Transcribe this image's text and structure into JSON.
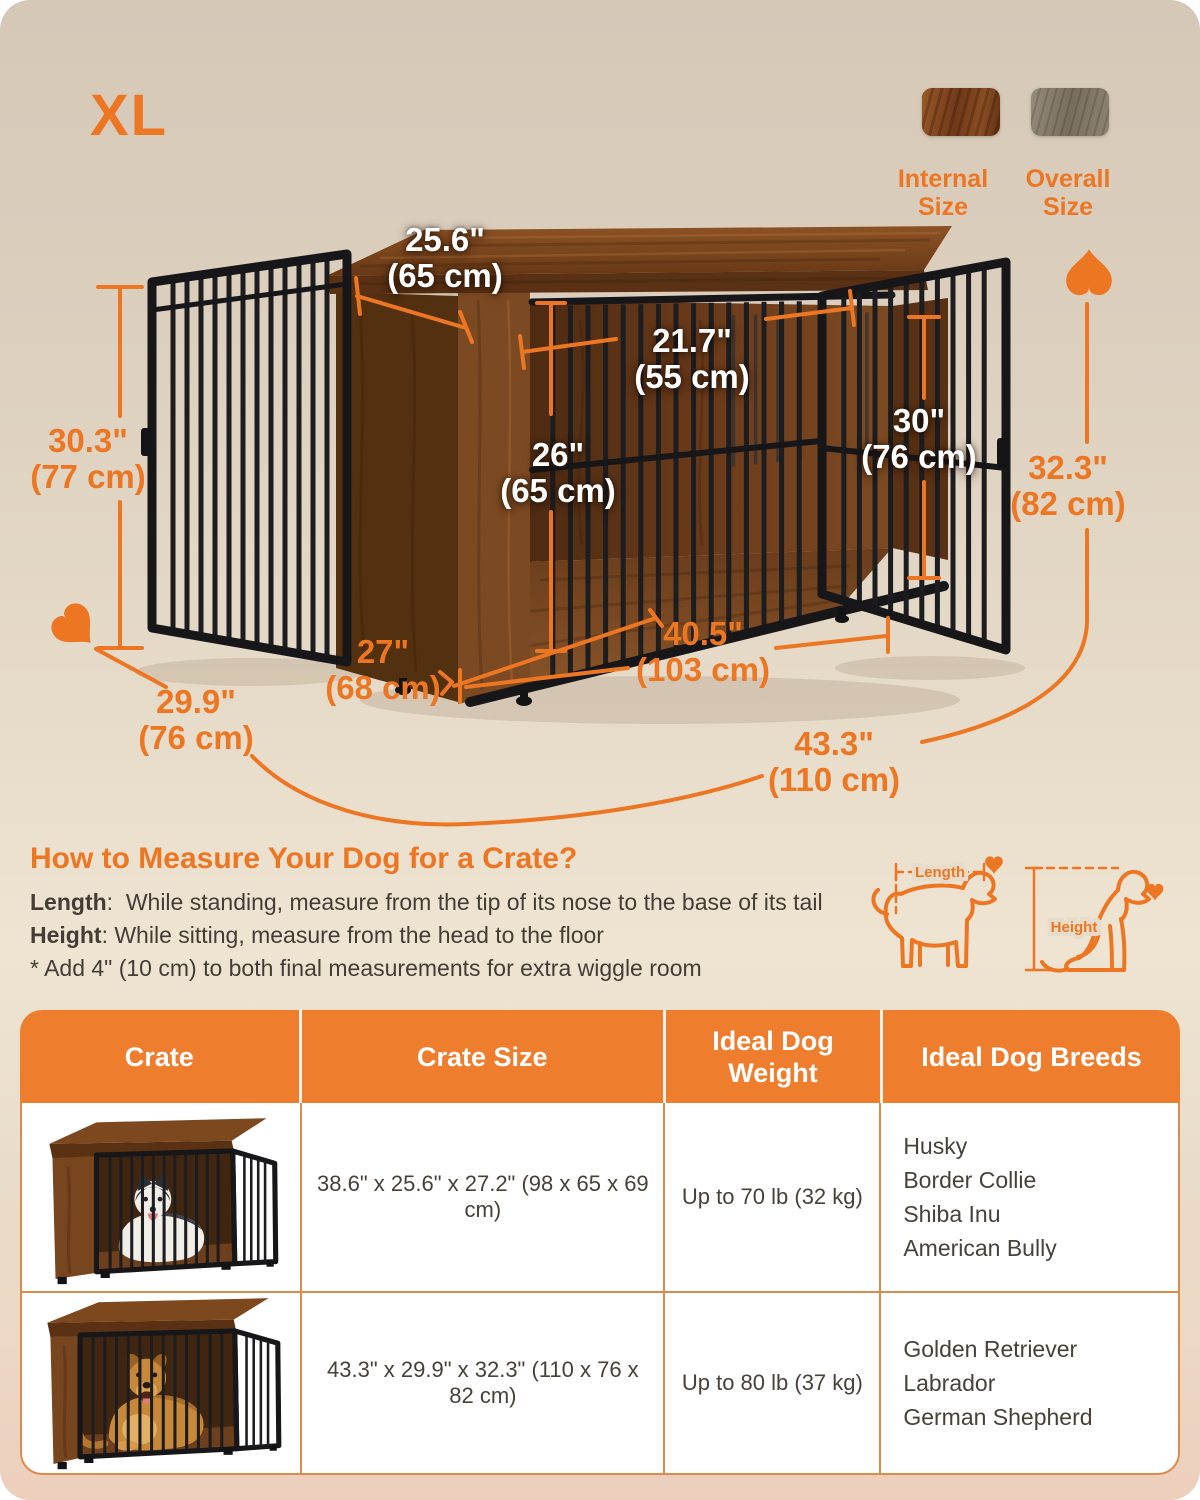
{
  "size_label": "XL",
  "legend": {
    "internal_label": "Internal Size",
    "overall_label": "Overall Size"
  },
  "dims": {
    "top_depth": {
      "in": "25.6\"",
      "cm": "(65 cm)"
    },
    "inner_depth": {
      "in": "21.7\"",
      "cm": "(55 cm)"
    },
    "inner_height": {
      "in": "26\"",
      "cm": "(65 cm)"
    },
    "door_height": {
      "in": "30\"",
      "cm": "(76 cm)"
    },
    "side_height": {
      "in": "30.3\"",
      "cm": "(77 cm)"
    },
    "overall_height": {
      "in": "32.3\"",
      "cm": "(82 cm)"
    },
    "base_depth": {
      "in": "27\"",
      "cm": "(68 cm)"
    },
    "inner_width": {
      "in": "40.5\"",
      "cm": "(103 cm)"
    },
    "overall_depth": {
      "in": "29.9\"",
      "cm": "(76 cm)"
    },
    "overall_width": {
      "in": "43.3\"",
      "cm": "(110 cm)"
    }
  },
  "measure_guide": {
    "title": "How to Measure Your Dog for a Crate?",
    "length_label": "Length",
    "length_text": ":  While standing, measure from the tip of its nose to the base of its tail",
    "height_label": "Height",
    "height_text": ": While sitting, measure from the head to the floor",
    "note": "* Add 4\" (10 cm) to both final measurements for extra wiggle room",
    "diagram_length_label": "Length",
    "diagram_height_label": "Height"
  },
  "table": {
    "headers": [
      "Crate",
      "Crate Size",
      "Ideal Dog Weight",
      "Ideal Dog Breeds"
    ],
    "rows": [
      {
        "size": "38.6\" x 25.6\" x 27.2\" (98 x 65 x 69 cm)",
        "weight": "Up to 70 lb (32 kg)",
        "breeds": [
          "Husky",
          "Border Collie",
          "Shiba Inu",
          "American Bully"
        ]
      },
      {
        "size": "43.3\" x 29.9\" x 32.3\" (110 x 76 x 82 cm)",
        "weight": "Up to 80 lb (37 kg)",
        "breeds": [
          "Golden Retriever",
          "Labrador",
          "German Shepherd"
        ]
      }
    ]
  },
  "colors": {
    "accent": "#ED7623",
    "table_header_bg": "#EE7D2E",
    "table_border": "#DC8B4B",
    "wood_brown": "#7A451F",
    "wood_grey": "#8D8373",
    "bar_black": "#1D1D20",
    "bg_top": "#D7C9B8",
    "bg_bottom": "#ECD0BE"
  }
}
